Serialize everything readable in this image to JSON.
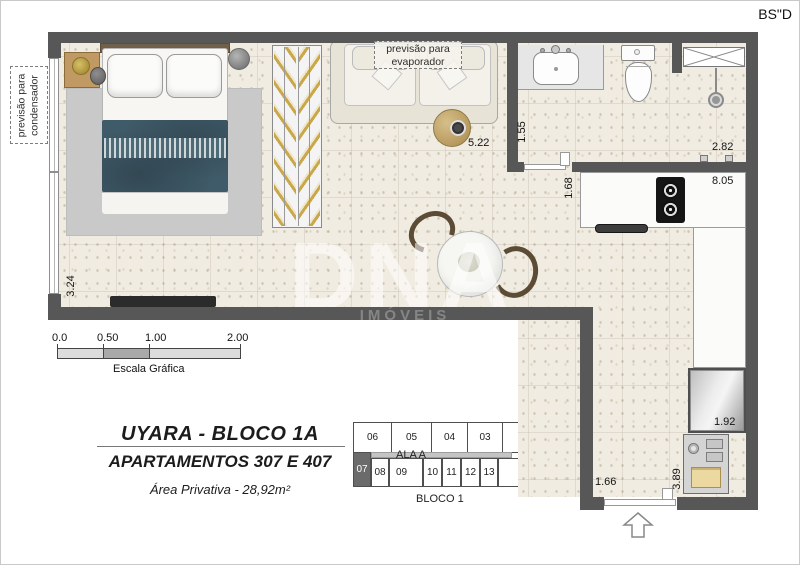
{
  "meta": {
    "bsd": "BS\"D"
  },
  "plan": {
    "annotations": {
      "evaporator": {
        "line1": "previsão para",
        "line2": "evaporador"
      },
      "condenser": {
        "line1": "previsão para",
        "line2": "condensador"
      }
    },
    "dimensions": {
      "living": "5.22",
      "bath": "1.55",
      "hall": "1.68",
      "shower": "2.82",
      "kitchen": "8.05",
      "bedroom": "3.24",
      "fridge": "1.92",
      "entry": "1.66",
      "service": "3.89"
    }
  },
  "scale_bar": {
    "ticks": [
      "0.0",
      "0.50",
      "1.00",
      "2.00"
    ],
    "caption": "Escala Gráfica"
  },
  "title_block": {
    "title": "UYARA - BLOCO 1A",
    "subtitle": "APARTAMENTOS 307 E 407",
    "area": "Área Privativa - 28,92m²"
  },
  "key_plan": {
    "top_row": [
      "06",
      "05",
      "04",
      "03",
      "02"
    ],
    "bottom_row": [
      "07",
      "08",
      "09",
      "10",
      "11",
      "12",
      "13",
      "01"
    ],
    "highlighted_unit": "07",
    "wing_label": "ALA A",
    "block_label": "BLOCO 1"
  },
  "watermark": {
    "logo": "DNA",
    "sub": "IMÓVEIS"
  },
  "colors": {
    "wall": "#575757",
    "floor": "#f1ece2",
    "blanket": "#3f5a68",
    "hanger_wood": "#c8a84b",
    "highlight_cell": "#6b6b6b"
  }
}
